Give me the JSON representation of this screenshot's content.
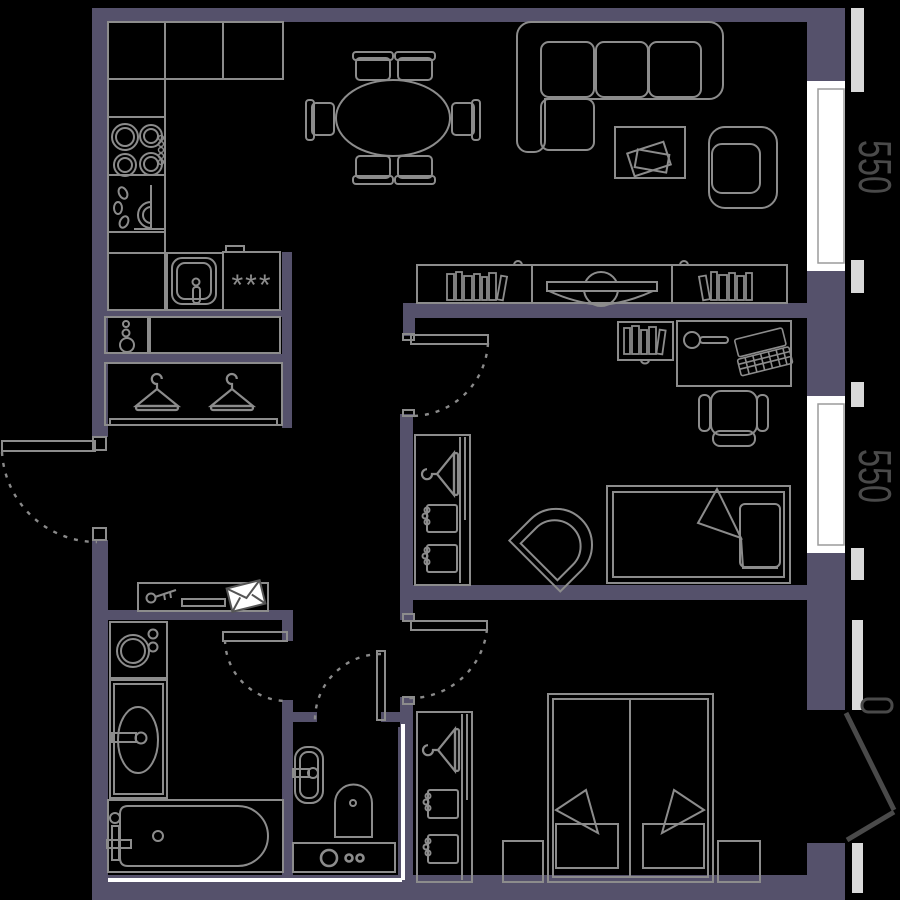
{
  "dimensions": {
    "window_top": "550",
    "window_middle": "550"
  },
  "symbols": {
    "freezer": "***"
  },
  "colors": {
    "background": "#000000",
    "wall": "#55516b",
    "outline": "#8c8c8c",
    "highlight": "#ffffff",
    "sill": "#d9d9d9",
    "dim_text": "#4a4a4a",
    "balcony_door": "#4a4a4a"
  },
  "icons": {
    "hanger": "clothes-hanger outline",
    "key": "key with teeth",
    "envelope": "white filled envelope",
    "freezer_stars": "three asterisks",
    "door_swing": "dashed quarter arc"
  }
}
